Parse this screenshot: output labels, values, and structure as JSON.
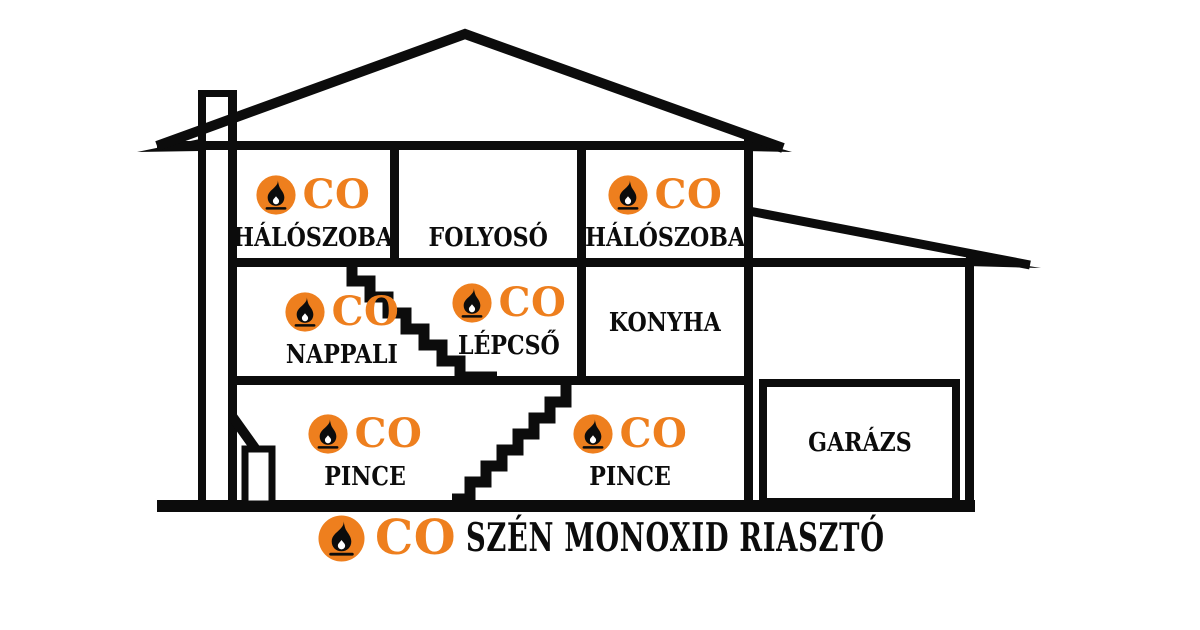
{
  "colors": {
    "accent": "#EE7F1E",
    "line": "#0C0C0C",
    "background": "#FFFFFF"
  },
  "co_label": "CO",
  "legend": {
    "co_label": "CO",
    "text": "SZÉN MONOXID RIASZTÓ"
  },
  "rooms": {
    "bedroom_left": {
      "label": "HÁLÓSZOBA",
      "has_co_alarm": true
    },
    "hallway": {
      "label": "FOLYOSÓ",
      "has_co_alarm": false
    },
    "bedroom_right": {
      "label": "HÁLÓSZOBA",
      "has_co_alarm": true
    },
    "living_room": {
      "label": "NAPPALI",
      "has_co_alarm": true
    },
    "staircase": {
      "label": "LÉPCSŐ",
      "has_co_alarm": true
    },
    "kitchen": {
      "label": "KONYHA",
      "has_co_alarm": false
    },
    "basement_left": {
      "label": "PINCE",
      "has_co_alarm": true
    },
    "basement_right": {
      "label": "PINCE",
      "has_co_alarm": true
    },
    "garage": {
      "label": "GARÁZS",
      "has_co_alarm": false
    }
  }
}
